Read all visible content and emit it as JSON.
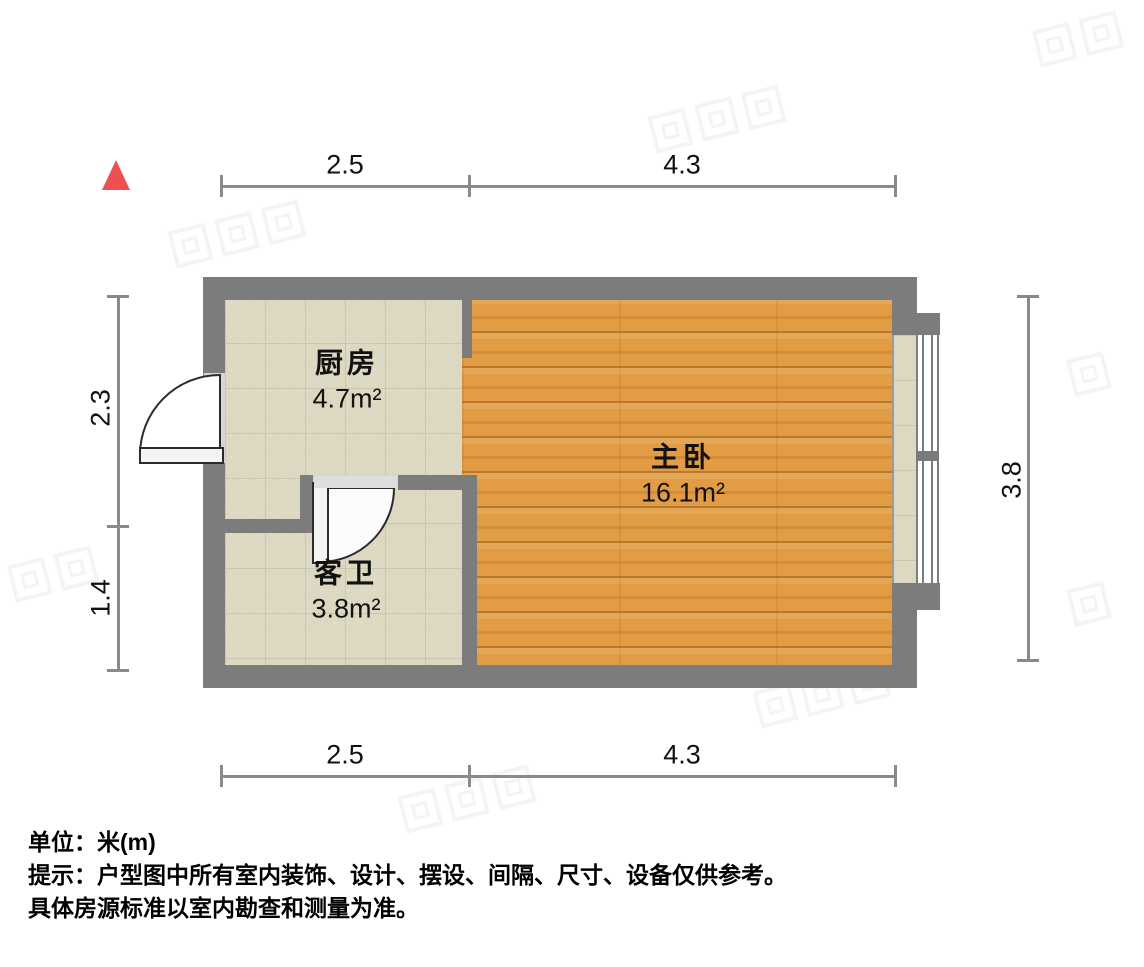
{
  "plan": {
    "unit_scale_note": "floor plan drawing",
    "north_arrow_color": "#ee5050"
  },
  "dimensions": {
    "top": [
      "2.5",
      "4.3"
    ],
    "bottom": [
      "2.5",
      "4.3"
    ],
    "left": [
      "2.3",
      "1.4"
    ],
    "right": [
      "3.8"
    ]
  },
  "rooms": {
    "kitchen": {
      "name": "厨房",
      "area": "4.7m²"
    },
    "bathroom": {
      "name": "客卫",
      "area": "3.8m²"
    },
    "bedroom": {
      "name": "主卧",
      "area": "16.1m²"
    }
  },
  "footer": {
    "unit_line": "单位：米(m)",
    "note_line1": "提示：户型图中所有室内装饰、设计、摆设、间隔、尺寸、设备仅供参考。",
    "note_line2": "具体房源标准以室内勘查和测量为准。"
  },
  "colors": {
    "wall": "#7c7c7c",
    "tile_floor": "#dcd8c2",
    "wood_floor": "#e19c44",
    "dimension_line": "#8a8a8a",
    "door_opening": "#d6d6d6"
  }
}
